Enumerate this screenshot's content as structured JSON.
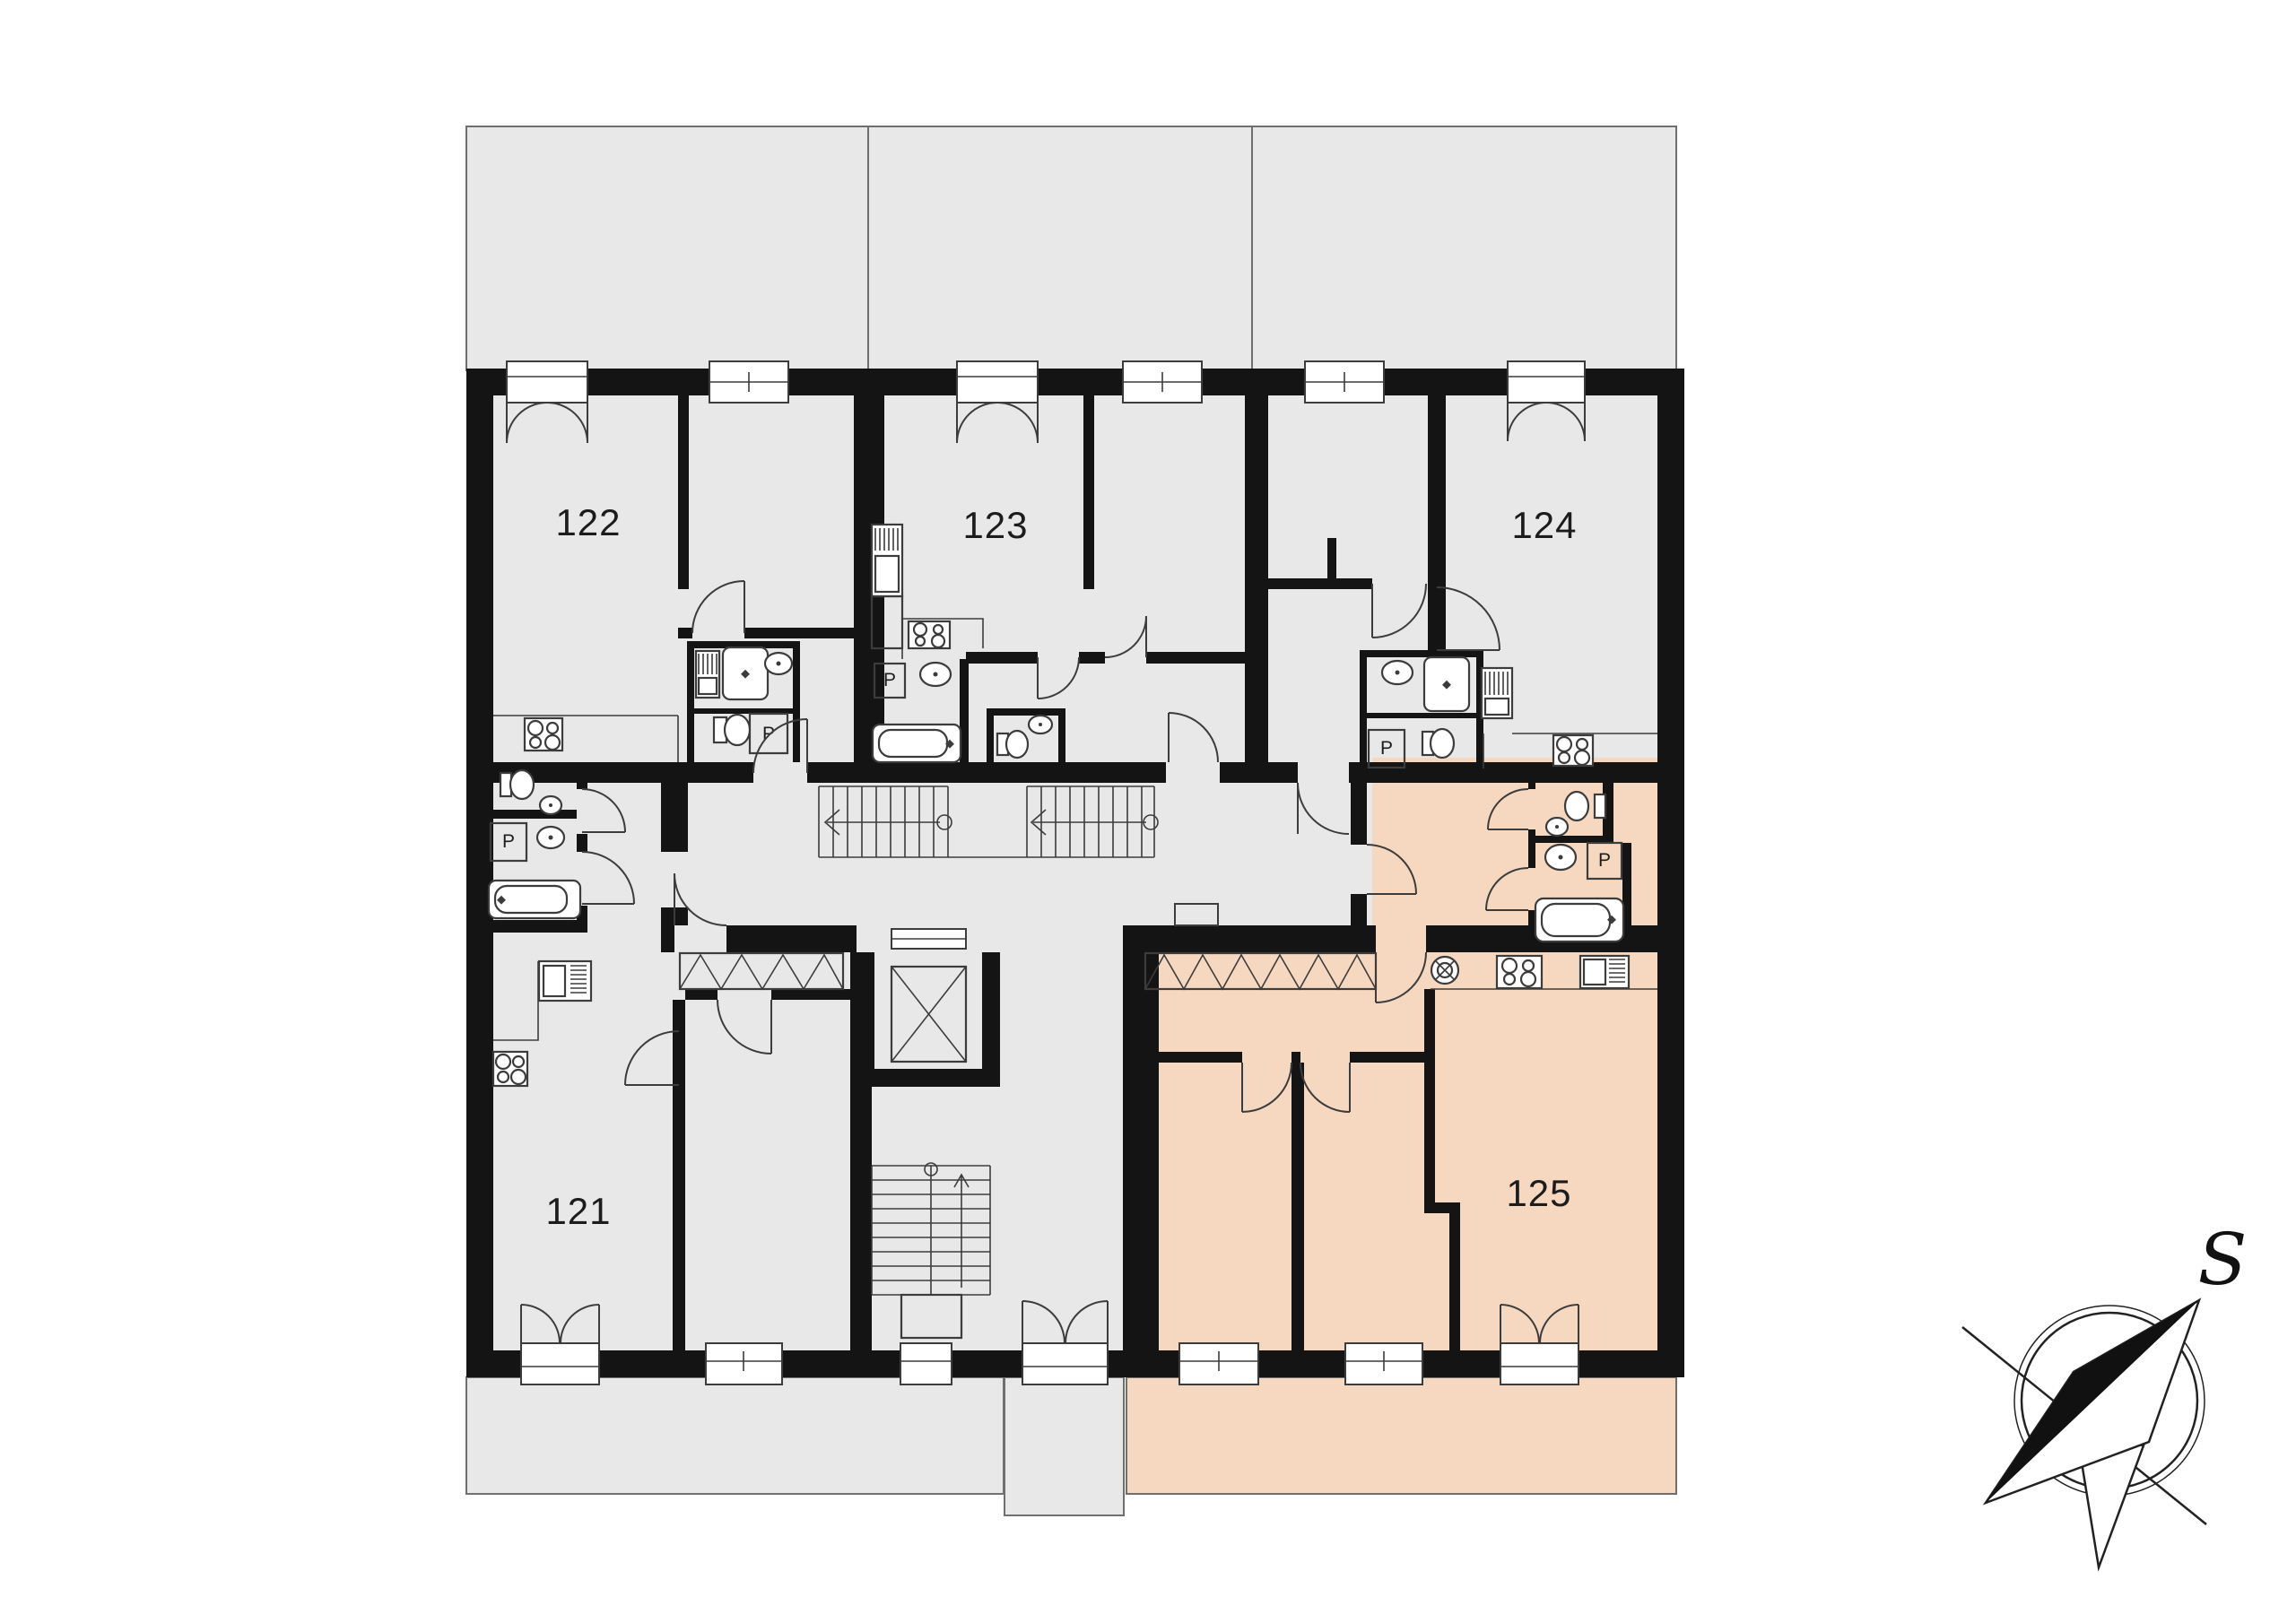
{
  "plan": {
    "type": "architectural-floor-plan",
    "apartments": [
      {
        "number": "121",
        "highlighted": false
      },
      {
        "number": "122",
        "highlighted": false
      },
      {
        "number": "123",
        "highlighted": false
      },
      {
        "number": "124",
        "highlighted": false
      },
      {
        "number": "125",
        "highlighted": true
      }
    ],
    "washing_machine_label": "P",
    "compass_label": "S",
    "features": [
      "terraces",
      "main-staircase",
      "lower-staircase",
      "elevator",
      "wardrobes",
      "kitchens",
      "bathrooms"
    ]
  },
  "colors": {
    "background": "#ffffff",
    "room_fill": "#e8e8e8",
    "terrace_fill": "#e8e8e8",
    "highlight_fill": "#f6d8c1",
    "wall": "#141414",
    "line": "#3c3c3c",
    "label_text": "#1c1c1c"
  }
}
